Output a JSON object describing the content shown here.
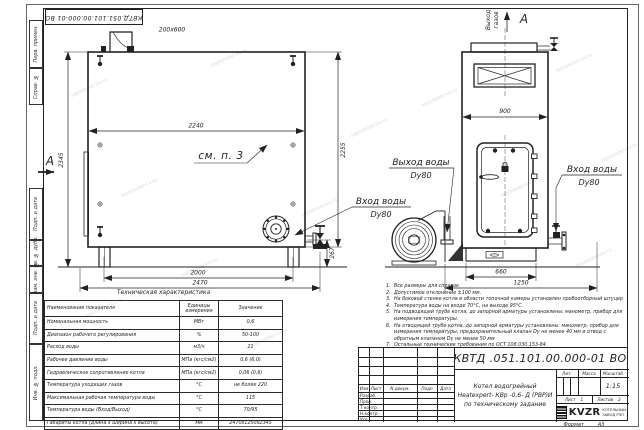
{
  "sheet": {
    "doc_number_stamp": "КВТД.051.101.00.000-01 ВО",
    "format_label": "Формат",
    "format_value": "А3",
    "watermark": "teplokotel-kv.ru"
  },
  "margin_labels": {
    "perv_primen": "Перв. примен.",
    "sprav_no": "Справ. №",
    "podp_data1": "Подп. и дата",
    "inv_dubl": "Инв. № дубл.",
    "vzam_inv": "Взам. инв. №",
    "podp_data2": "Подп. и дата",
    "inv_podl": "Инв. № подл."
  },
  "left_view": {
    "dims": {
      "chimney": "200х600",
      "top_width": "2240",
      "height_total": "2345",
      "height_body": "2255",
      "inlet_height": "267",
      "legs_span": "2000",
      "total_width": "2470"
    },
    "see_note": "см. п. 3",
    "section_mark": "А",
    "water_inlet_line1": "Вход воды",
    "water_inlet_line2": "Dy80"
  },
  "right_view": {
    "dims": {
      "top_width": "900",
      "base_width": "660",
      "total_depth": "1250"
    },
    "gas_outlet_line1": "Выход",
    "gas_outlet_line2": "газов",
    "section_mark": "А",
    "water_outlet_line1": "Выход воды",
    "water_outlet_line2": "Dy80",
    "water_inlet_line1": "Вход воды",
    "water_inlet_line2": "Dy80"
  },
  "tech_table": {
    "title": "Техническая характеристика",
    "headers": [
      "Наименование показателя",
      "Единицы измерения",
      "Значение"
    ],
    "rows": [
      [
        "Номинальная мощность",
        "МВт",
        "0,6"
      ],
      [
        "Диапазон рабочего регулирования",
        "%",
        "50-100"
      ],
      [
        "Расход воды",
        "м3/ч",
        "21"
      ],
      [
        "Рабочее давление воды",
        "МПа (кгс/см2)",
        "0,6 (6,0)"
      ],
      [
        "Гидравлическое сопротивление котла",
        "МПа (кгс/см2)",
        "0,06 (0,6)"
      ],
      [
        "Температура уходящих газов",
        "°С",
        "не более 220"
      ],
      [
        "Максимальная рабочая температура воды",
        "°С",
        "115"
      ],
      [
        "Температура воды (Вход/Выход)",
        "°С",
        "70/95"
      ],
      [
        "Габариты котла (длина х ширина х высота)",
        "мм",
        "2470х1250х2345"
      ]
    ]
  },
  "notes": [
    {
      "n": "1.",
      "text": "Все размеры для справок"
    },
    {
      "n": "2.",
      "text": "Допустимое отклонение ±100 мм."
    },
    {
      "n": "3.",
      "text": "На боковой стенке котла в области топочной камеры установлен пробоотборный штуцер"
    },
    {
      "n": "4.",
      "text": "Температура воды на входе 70°С, на выходе 95°С."
    },
    {
      "n": "5.",
      "text": "На подводящей трубе котла, до запорной арматуры установлены: манометр, прибор для измерения температуры."
    },
    {
      "n": "6.",
      "text": "На отводящей трубе котла, до запорной арматуры установлены: манометр, прибор для измерения температуры, предохранительный клапан Dy не менее 40 мм и отвод с обратным клапаном Dy не менее 50 мм"
    },
    {
      "n": "7.",
      "text": "Остальные технические требования по ОСТ 108.030.153-84."
    }
  ],
  "title_block": {
    "doc_number": "КВТД .051.101.00.000-01  ВО",
    "name_line1": "Котел водогрейный",
    "name_line2": "Heatexpert- КВр -0,6- Д (РВР)И",
    "name_line3": "по техническому задание",
    "col_izm": "Изм",
    "col_list": "Лист",
    "col_ndoc": "N докум.",
    "col_podp": "Подп",
    "col_data": "Дата",
    "row_razrab": "Разраб.",
    "row_prov": "Пров.",
    "row_tkontr": "Т.контр.",
    "row_nkontr": "Н.контр.",
    "row_utv": "Утв.",
    "lit_label": "Лит.",
    "mass_label": "Масса",
    "scale_label": "Масштаб",
    "scale_value": "1:15",
    "sheet_label": "Лист",
    "sheet_value": "1",
    "sheets_label": "Листов",
    "sheets_value": "2",
    "logo_text": "KVZR",
    "company_line1": "КОТЕЛЬНЫЙ",
    "company_line2": "ЗАВОД РЭП"
  }
}
